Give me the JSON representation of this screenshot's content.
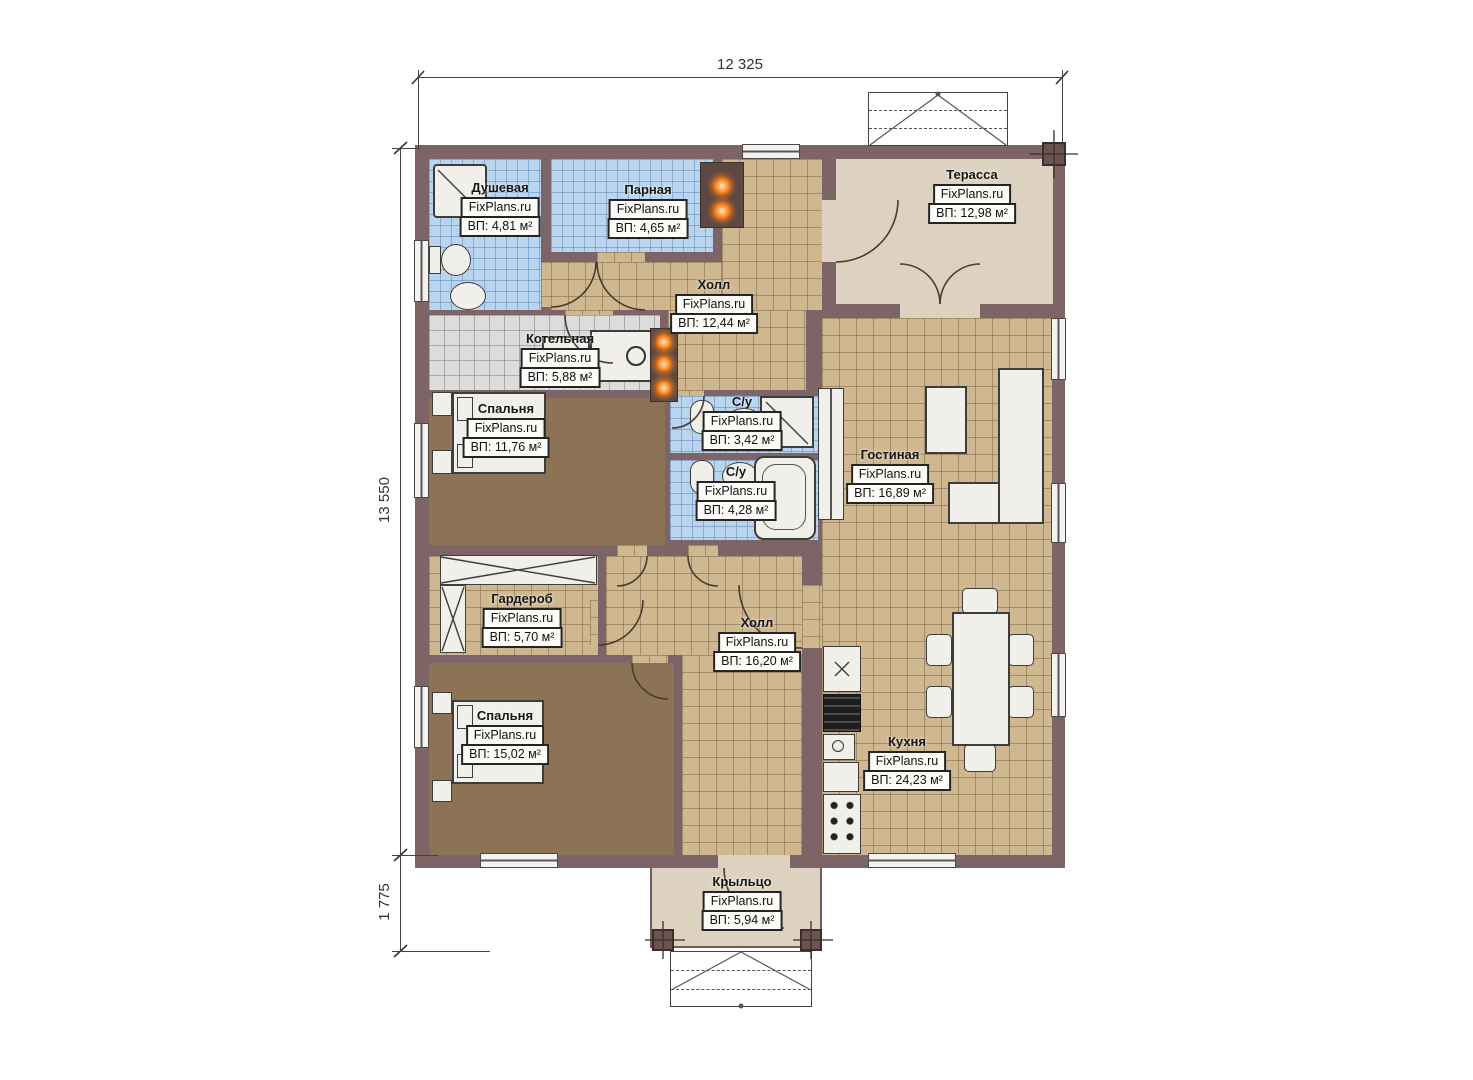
{
  "plan": {
    "dimensions": {
      "top": "12 325",
      "left": "13 550",
      "left_bottom": "1 775"
    },
    "rooms": [
      {
        "id": "dushevaya",
        "name": "Душевая",
        "watermark": "FixPlans.ru",
        "area": "ВП: 4,81 м²"
      },
      {
        "id": "parnaya",
        "name": "Парная",
        "watermark": "FixPlans.ru",
        "area": "ВП: 4,65 м²"
      },
      {
        "id": "hall-upper",
        "name": "Холл",
        "watermark": "FixPlans.ru",
        "area": "ВП: 12,44 м²"
      },
      {
        "id": "terrace",
        "name": "Терасса",
        "watermark": "FixPlans.ru",
        "area": "ВП: 12,98 м²"
      },
      {
        "id": "kotelnaya",
        "name": "Котельная",
        "watermark": "FixPlans.ru",
        "area": "ВП: 5,88 м²"
      },
      {
        "id": "bedroom-upper",
        "name": "Спальня",
        "watermark": "FixPlans.ru",
        "area": "ВП: 11,76 м²"
      },
      {
        "id": "su-upper",
        "name": "С/у",
        "watermark": "FixPlans.ru",
        "area": "ВП: 3,42 м²"
      },
      {
        "id": "su-lower",
        "name": "С/у",
        "watermark": "FixPlans.ru",
        "area": "ВП: 4,28 м²"
      },
      {
        "id": "living",
        "name": "Гостиная",
        "watermark": "FixPlans.ru",
        "area": "ВП: 16,89 м²"
      },
      {
        "id": "garderob",
        "name": "Гардероб",
        "watermark": "FixPlans.ru",
        "area": "ВП: 5,70 м²"
      },
      {
        "id": "hall-lower",
        "name": "Холл",
        "watermark": "FixPlans.ru",
        "area": "ВП: 16,20 м²"
      },
      {
        "id": "bedroom-lower",
        "name": "Спальня",
        "watermark": "FixPlans.ru",
        "area": "ВП: 15,02 м²"
      },
      {
        "id": "kitchen",
        "name": "Кухня",
        "watermark": "FixPlans.ru",
        "area": "ВП: 24,23 м²"
      },
      {
        "id": "porch",
        "name": "Крыльцо",
        "watermark": "FixPlans.ru",
        "area": "ВП: 5,94 м²"
      }
    ],
    "colors": {
      "wall": "#7d6567",
      "floor_tile_tan": "#cfb78f",
      "floor_tile_blue": "#b9d4ee",
      "floor_tile_gray": "#dcdcdc",
      "floor_carpet": "#8c7356",
      "terrace_floor": "#ddd2bf",
      "heater_orange": "#f07818"
    }
  }
}
